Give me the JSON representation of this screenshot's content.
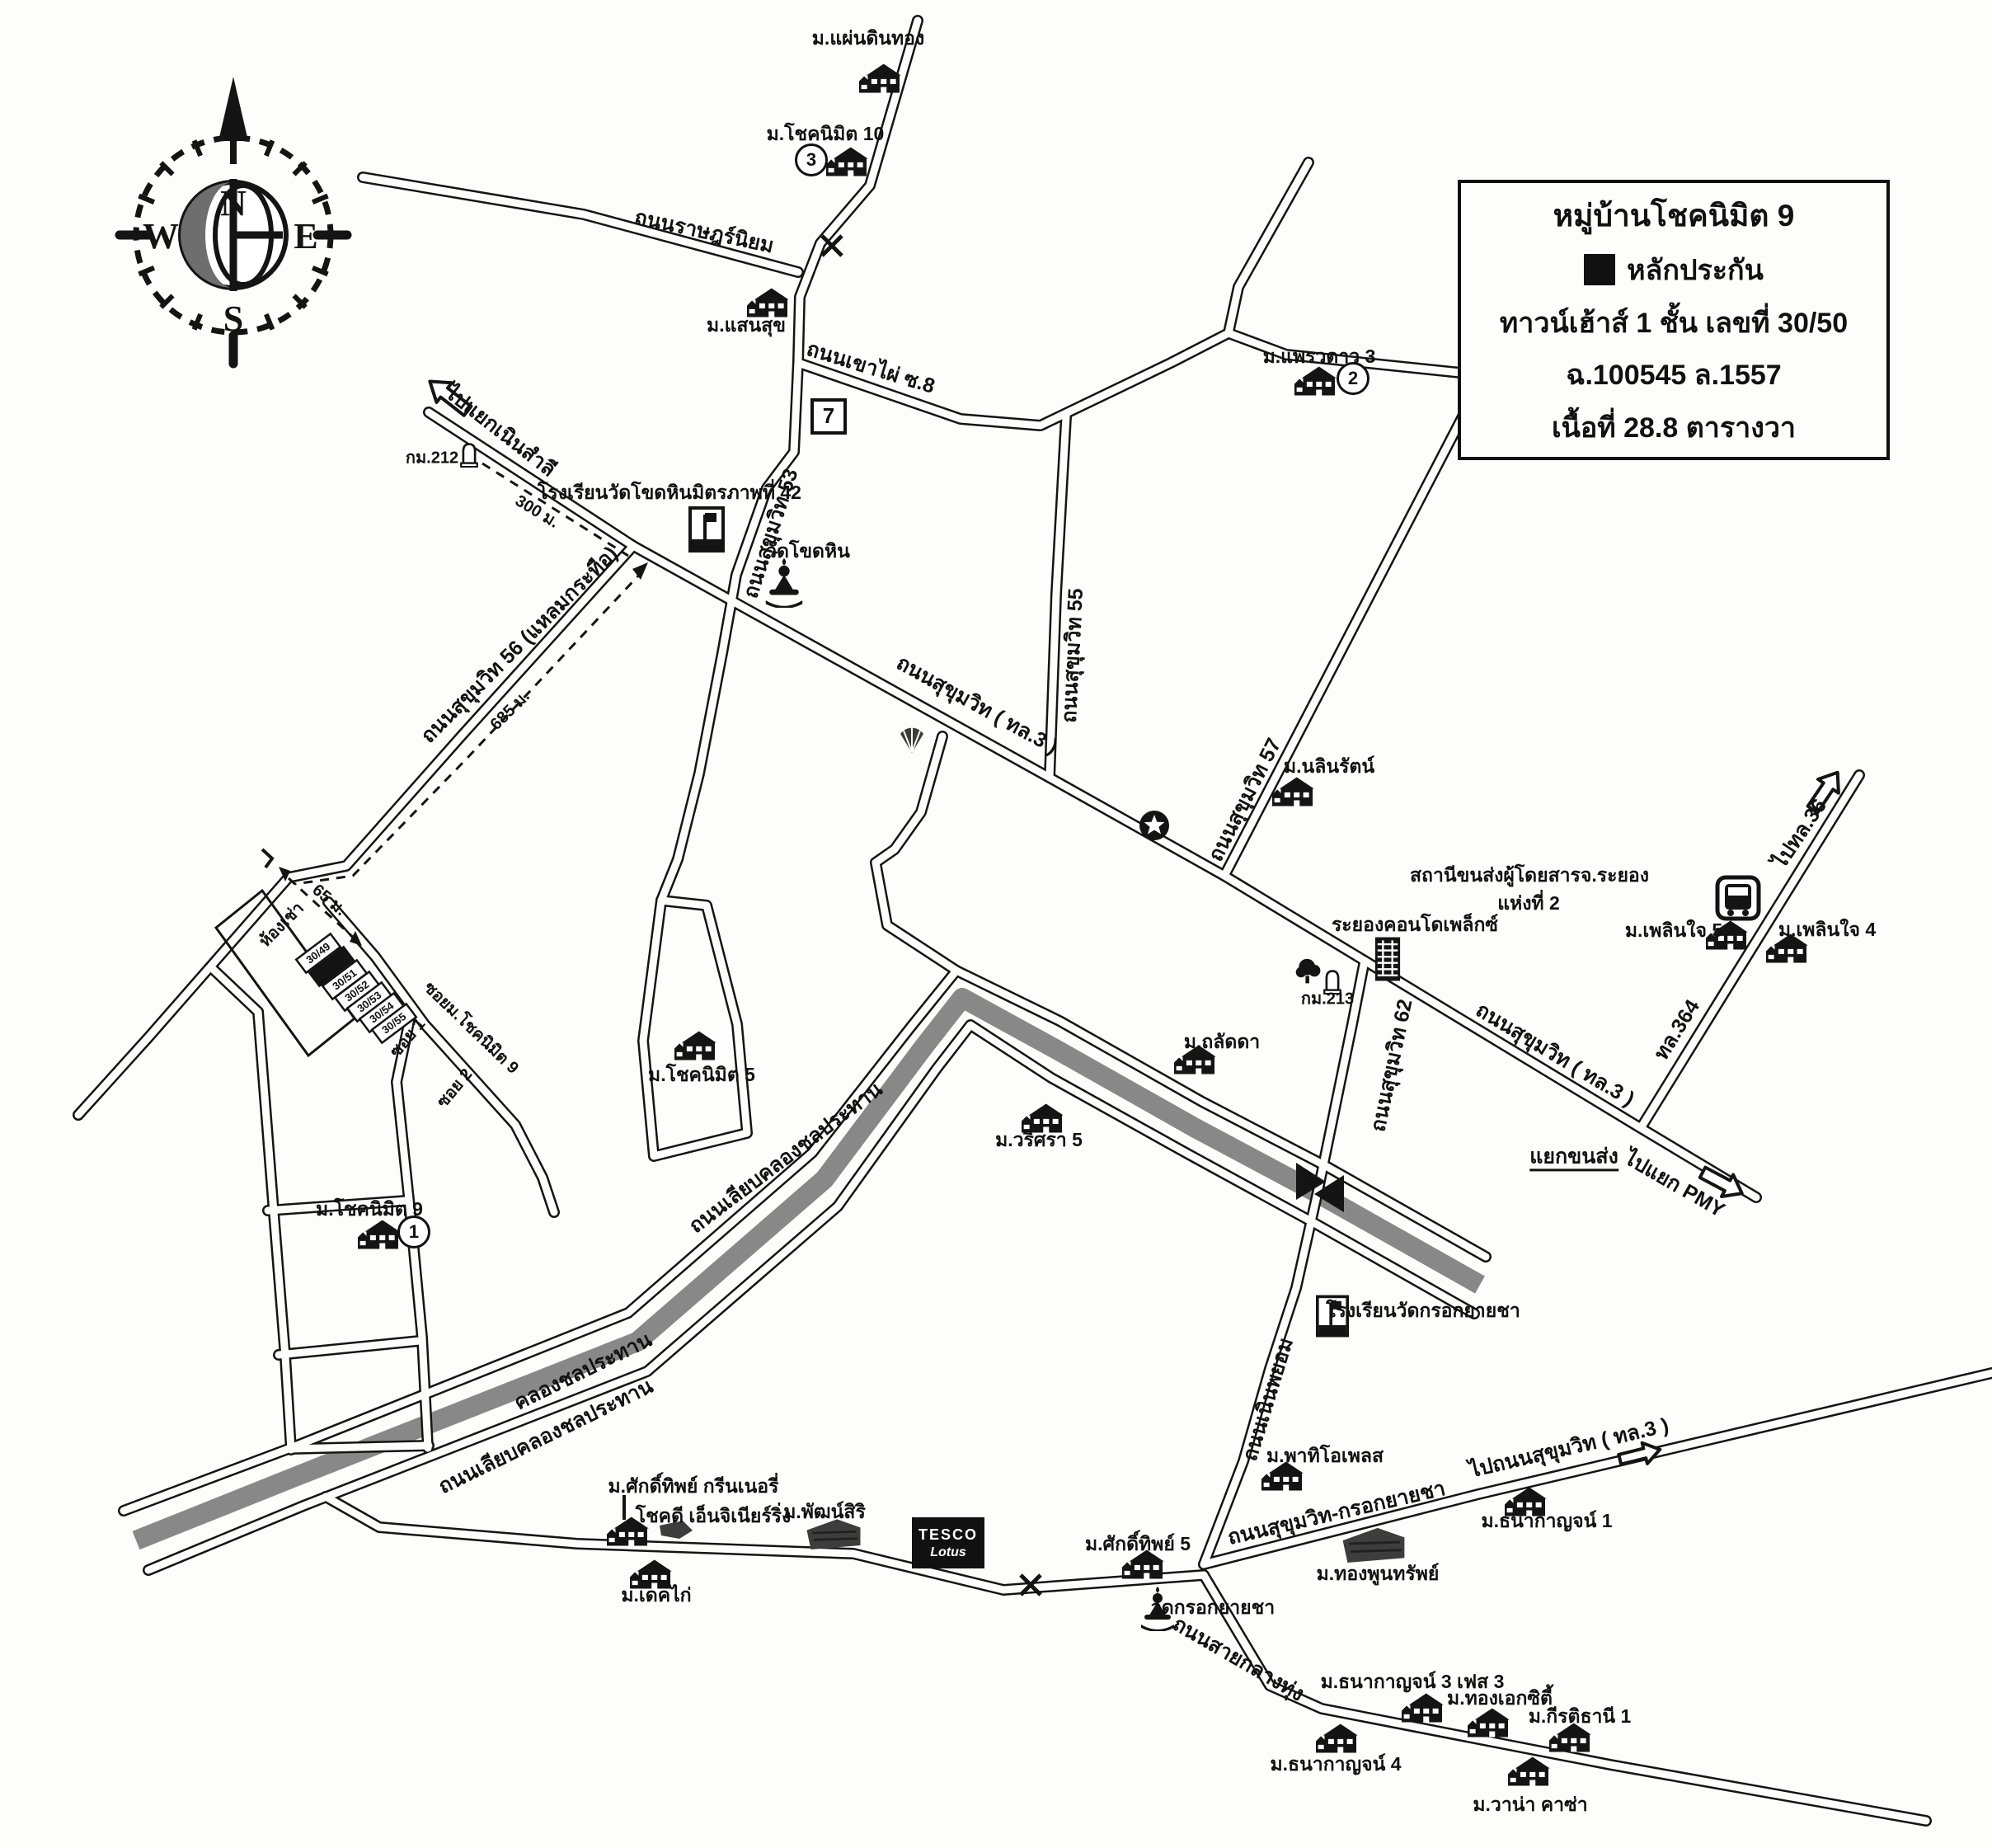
{
  "legend": {
    "title": "หมู่บ้านโชคนิมิต 9",
    "marker_label": "หลักประกัน",
    "line1": "ทาวน์เฮ้าส์ 1 ชั้น เลขที่ 30/50",
    "line2": "ฉ.100545 ล.1557",
    "line3": "เนื้อที่ 28.8 ตารางวา"
  },
  "compass": {
    "n": "N",
    "e": "E",
    "s": "S",
    "w": "W"
  },
  "villages": {
    "phaendinthong": "ม.แผ่นดินทอง",
    "choknimit10": "ม.โชคนิมิต 10",
    "saensuk": "ม.แสนสุข",
    "phraewdao3": "ม.แพรวดาว 3",
    "nalinrat": "ม.นลินรัตน์",
    "choknimit5": "ม.โชคนิมิต 5",
    "choknimit9": "ม.โชคนิมิต 9",
    "thalatda": "ม.ถลัดดา",
    "warisara5": "ม.วริศรา 5",
    "phloenchai5": "ม.เพลินใจ 5",
    "phloenchai4": "ม.เพลินใจ 4",
    "patio_place": "ม.พาทิโอเพลส",
    "sakthip5": "ม.ศักดิ์ทิพย์ 5",
    "thanakan1": "ม.ธนากาญจน์ 1",
    "thongphunsap": "ม.ทองพูนทรัพย์",
    "thanakan3": "ม.ธนากาญจน์ 3 เฟส 3",
    "thongekcity": "ม.ทองเอกซิตี้",
    "kiratithani1": "ม.กีรติธานี 1",
    "thanakan4": "ม.ธนากาญจน์ 4",
    "vana_casa": "ม.วาน่า คาซ่า",
    "sakthip_greenery": "ม.ศักดิ์ทิพย์ กรีนเนอรี่",
    "chokdee_engineering": "โชคดี เอ็นจิเนียร์ริ่ง",
    "decca": "ม.เดคไก่",
    "phatsiri": "ม.พัฒน์สิริ"
  },
  "religious": {
    "wat_khodhin": "วัดโขดหิน",
    "wat_krokyaicha": "วัดกรอกยายชา"
  },
  "schools": {
    "school_khodhin": "โรงเรียนวัดโขดหินมิตรภาพที่ 42",
    "school_krokyaicha": "โรงเรียนวัดกรอกยายชา"
  },
  "transit": {
    "bus_terminal_1": "สถานีขนส่งผู้โดยสารจ.ระยอง",
    "bus_terminal_2": "แห่งที่ 2",
    "condoplex": "ระยองคอนโดเพล็กซ์"
  },
  "roads": {
    "ratniyom": "ถนนราษฎร์นิยม",
    "khaophai8": "ถนนเขาไผ่ ซ.8",
    "s53": "ถนนสุขุมวิท 53",
    "s55": "ถนนสุขุมวิท 55",
    "s56": "ถนนสุขุมวิท 56 (แหลมกระทือ)",
    "s57": "ถนนสุขุมวิท 57",
    "s62": "ถนนสุขุมวิท 62",
    "sukhumvit_tl3_a": "ถนนสุขุมวิท ( ทล.3 )",
    "sukhumvit_tl3_b": "ถนนสุขุมวิท ( ทล.3 )",
    "noenphayom": "ถนนเนินพยอม",
    "sukhumvit_krokyaicha": "ถนนสุขุมวิท-กรอกยายชา",
    "saiklangthung": "ถนนสายกลางทุ่ง",
    "liapkhlong_a": "ถนนเลียบคลองชลประทาน",
    "liapkhlong_b": "ถนนเลียบคลองชลประทาน",
    "khlong": "คลองชลประทาน",
    "tl364": "ทล.364"
  },
  "directions": {
    "to_noensamli": "ไปแยกเนินสำลี",
    "to_tl36": "ไปทล.36",
    "to_pmy": "ไปแยก PMY",
    "to_sukhumvit": "ไปถนนสุขุมวิท ( ทล.3 )",
    "yaek_khonsong": "แยกขนส่ง"
  },
  "distances": {
    "d300": "300 ม.",
    "d685": "685 ม.",
    "d65": "65 ม."
  },
  "km": {
    "km212": "กม.212",
    "km213": "กม.213"
  },
  "plots": {
    "p49": "30/49",
    "p51": "30/51",
    "p52": "30/52",
    "p53": "30/53",
    "p54": "30/54",
    "p55": "30/55"
  },
  "sois": {
    "soi1": "ซอย 1",
    "soi2": "ซอย 2",
    "soi_choknimit9": "ซอยม.โชคนิมิต 9",
    "rental_rooms": "ห้องเช่า"
  },
  "markers": {
    "n1": "1",
    "n2": "2",
    "n3": "3"
  },
  "pois": {
    "seven": "7",
    "tesco1": "TESCO",
    "tesco2": "Lotus"
  },
  "colors": {
    "ink": "#141414",
    "canal": "#828282",
    "paper": "#fdfdfc"
  }
}
